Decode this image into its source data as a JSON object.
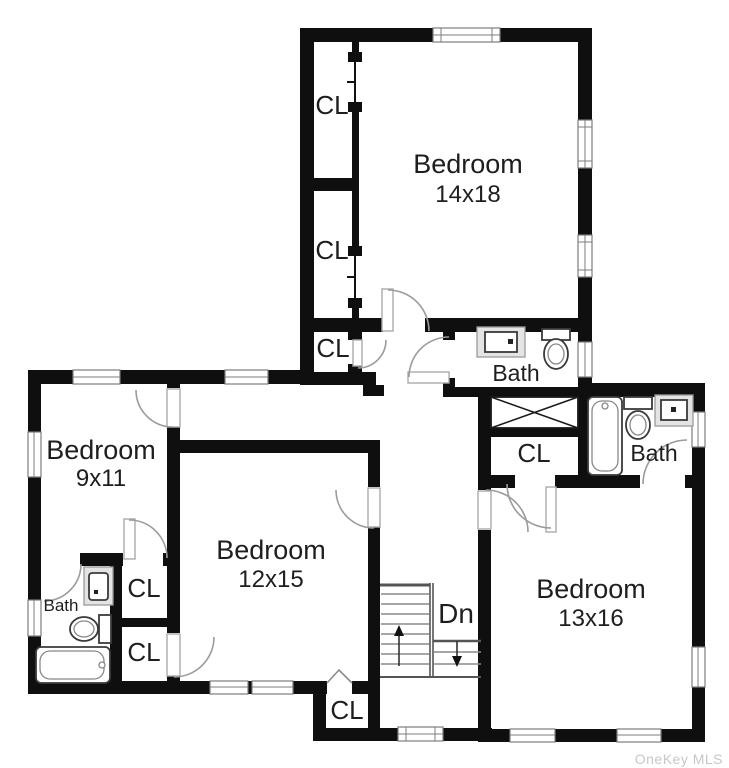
{
  "floor_plan": {
    "labels": {
      "bedroom_top": {
        "name": "Bedroom",
        "dims": "14x18"
      },
      "bedroom_left": {
        "name": "Bedroom",
        "dims": "9x11"
      },
      "bedroom_mid": {
        "name": "Bedroom",
        "dims": "12x15"
      },
      "bedroom_right": {
        "name": "Bedroom",
        "dims": "13x16"
      },
      "bath_top": "Bath",
      "bath_right": "Bath",
      "bath_left": "Bath",
      "closet": "CL",
      "stairs_down": "Dn",
      "watermark": "OneKey MLS"
    },
    "colors": {
      "wall": "#0f0f0f",
      "door": "#9b9b9b",
      "window_frame": "#7d7d7d",
      "fixture": "#3a3a3a",
      "vanity_fill": "#e4e4e4",
      "stair_line": "#8a8a8a",
      "stair_edge": "#555555",
      "text": "#1e1e1e",
      "watermark": "#c7c7c7",
      "background": "#ffffff"
    }
  }
}
